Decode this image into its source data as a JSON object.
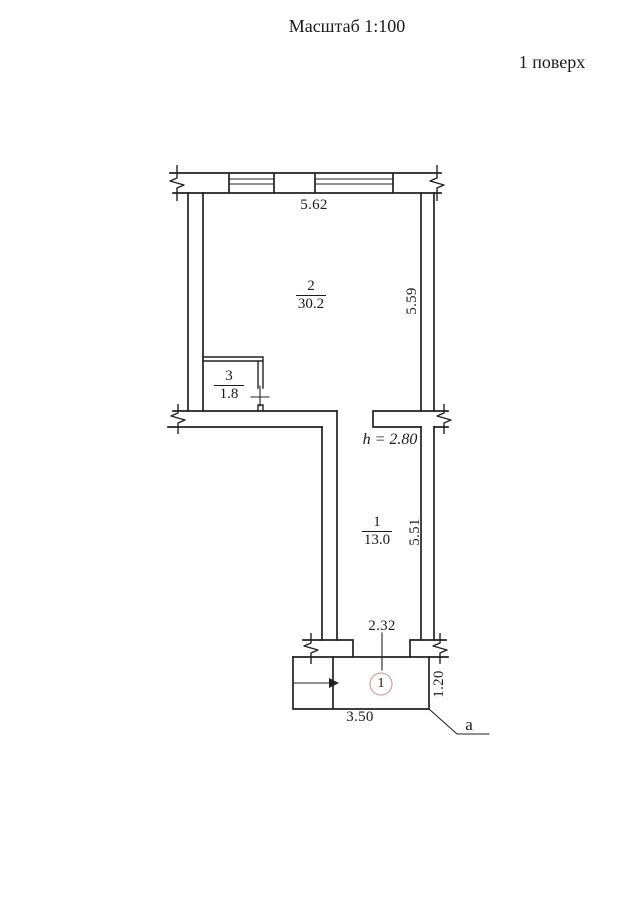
{
  "header": {
    "scale_label": "Масштаб 1:100",
    "floor_label": "1 поверх"
  },
  "rooms": [
    {
      "number": "2",
      "area": "30.2"
    },
    {
      "number": "3",
      "area": "1.8"
    },
    {
      "number": "1",
      "area": "13.0"
    }
  ],
  "dimensions": {
    "top_width": "5.62",
    "room2_depth": "5.59",
    "room1_depth": "5.51",
    "door_opening": "2.32",
    "porch_width": "3.50",
    "porch_depth": "1.20",
    "ceiling_height": "h = 2.80"
  },
  "annotations": {
    "entrance_marker": "1",
    "section_letter": "а"
  },
  "icons": {
    "wall_break": "zigzag-break",
    "entrance_arrow": "arrow-right",
    "door_leaf": "cross-tick",
    "entrance_marker": "circled-number"
  },
  "colors": {
    "line": "#222222",
    "marker_circle": "#d9a2ad",
    "background": "#ffffff"
  }
}
